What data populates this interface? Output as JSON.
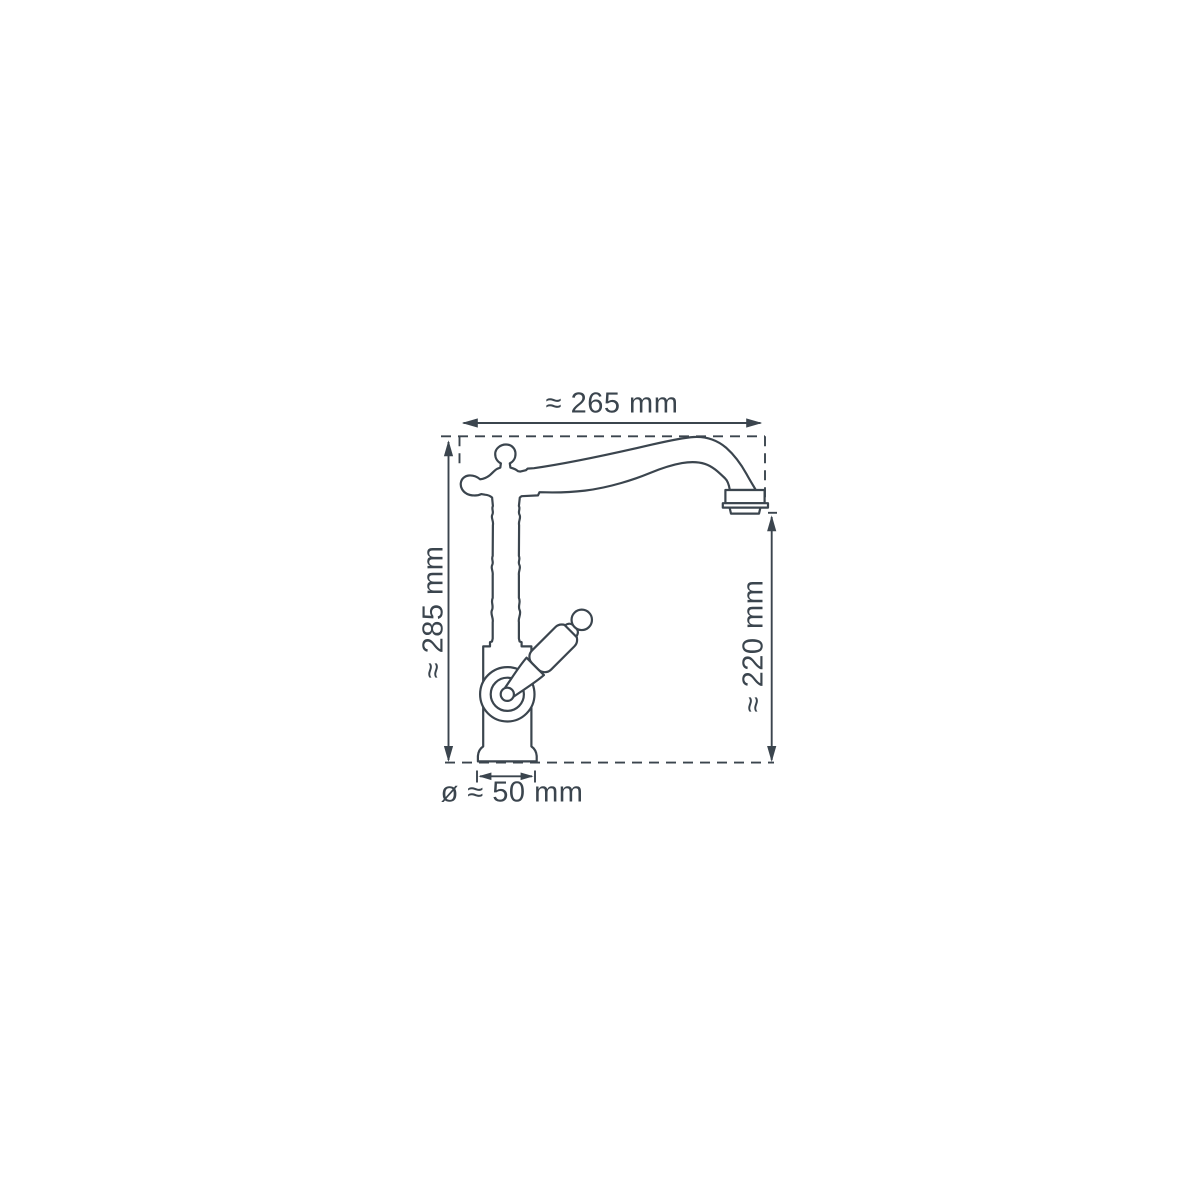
{
  "diagram": {
    "subject": "kitchen-faucet-technical-dimension-drawing",
    "view": "side-view-line-art",
    "line_color": "#3b454e",
    "bg_color": "#ffffff",
    "labels": {
      "width_top": "≈ 265 mm",
      "height_total": "≈ 285 mm",
      "height_spout": "≈ 220 mm",
      "base_diameter": "ø ≈ 50 mm"
    }
  }
}
